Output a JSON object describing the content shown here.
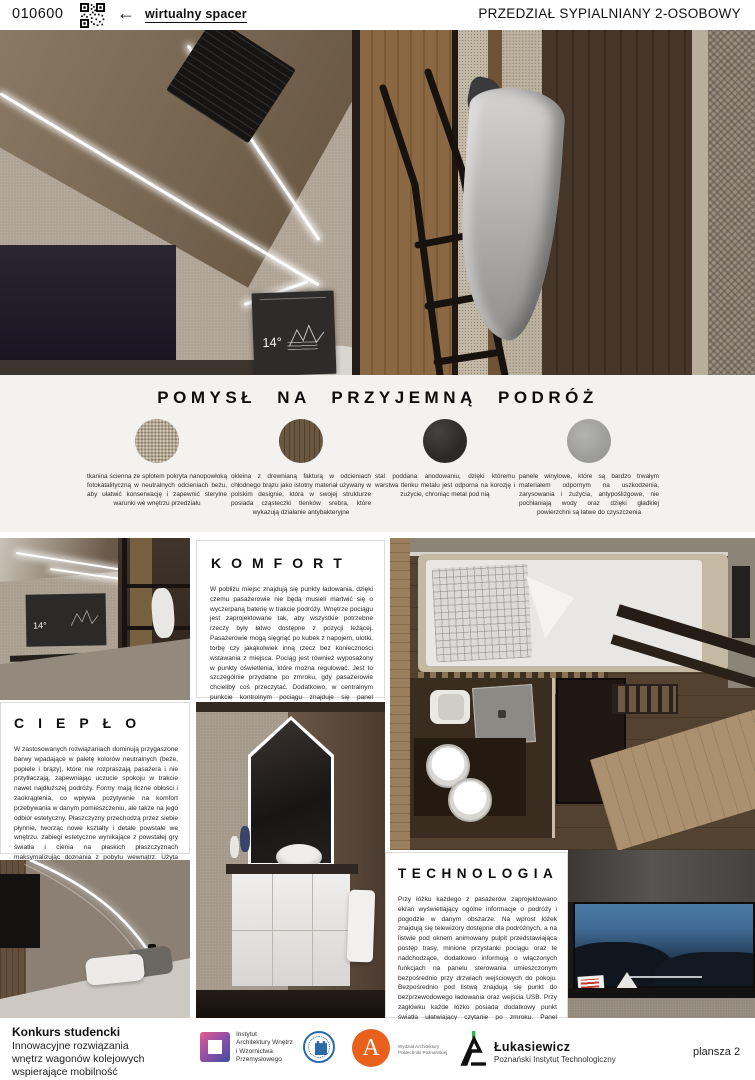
{
  "header": {
    "code": "010600",
    "virtual_tour_label": "wirtualny spacer",
    "title": "PRZEDZIAŁ SYPIALNIANY 2-OSOBOWY"
  },
  "icons": {
    "arrow_left": "←"
  },
  "screens": {
    "temperature": "14°"
  },
  "materials": {
    "title": "POMYSŁ NA PRZYJEMNĄ PODRÓŻ",
    "swatches": [
      {
        "name": "tkanina ścienna",
        "color": "#b3a690",
        "description": "tkanina ścienna ze splotem pokryta nanopowłoką fotokatalityczną w neutralnych odcieniach beżu, aby ułatwić konserwację i zapewnić sterylne warunki we wnętrzu przedziału"
      },
      {
        "name": "okleina drewniana",
        "color": "#6b5740",
        "description": "okleina z drewnianą fakturą w odcieniach chłodnego brązu jako istotny materiał używany w polskim designie, która w swojej strukturze posiada cząsteczki tlenków srebra, które wykazują działanie antybakteryjne"
      },
      {
        "name": "stal anodowana",
        "color": "#2c2a27",
        "description": "stal poddana anodowaniu, dzięki któremu warstwa tlenku metalu jest odporna na korozję i zużycie, chroniąc metal pod nią"
      },
      {
        "name": "panele winylowe",
        "color": "#9b9b99",
        "description": "panele winylowe, które są bardzo trwałym materiałem odpornym na uszkodzenia, zarysowania i zużycia, antypoślizgowe, nie pochłaniają wody oraz dzięki gładkiej powierzchni są łatwe do czyszczenia"
      }
    ]
  },
  "sections": {
    "komfort": {
      "title": "KOMFORT",
      "body": "W pobliżu miejsc znajdują się punkty ładowania, dzięki czemu pasażerowie nie będą musieli martwić się o wyczerpaną baterię w trakcie podróży. Wnętrze pociągu jest zaprojektowane tak, aby wszystkie potrzebne rzeczy były łatwo dostępne z pozycji leżącej. Pasażerowie mogą sięgnąć po kubek z napojem, ulotki, torbę czy jakąkolwiek inną rzecz bez konieczności wstawania z miejsca. Pociąg jest również wyposażony w punkty oświetlenia, które można regulować. Jest to szczególnie przydatne po zmroku, gdy pasażerowie chcieliby coś przeczytać. Dodatkowo, w centralnym punkcie kontrolnym pociągu znajduje się panel sterowania, który umożliwia pasażerom regulowanie temperatury i jasności świateł. Dzięki temu podróżni mogą dostosować warunki w pokoju do swoich preferencji, zapewniając sobie maksymalny komfort podczas podróży."
    },
    "cieplo": {
      "title": "CIEPŁO",
      "body": "W zastosowanych rozwiązaniach dominują przygaszone barwy wpadające w paletę kolorów neutralnych (beże, popiele i brązy), które nie rozpraszają pasażera i nie przytłaczają, zapewniając uczucie spokoju w trakcie nawet najdłuższej podróży. Formy mają liczne obłości i zaokrąglenia, co wpływa pozytywnie na komfort przebywania w danym pomieszczeniu, ale także na jego odbiór estetyczny. Płaszczyzny przechodzą przez siebie płynnie, tworząc nowe kształty i detale powstałe we wnętrzu. zabiegi estetyczne wynikające z powstałej gry światła i cienia na płaskich płaszczyznach maksymalizując doznania z pobytu wewnątrz. Użyta tkanina w połączeniu z drewnem ociepla pomieszczenie."
    },
    "technologia": {
      "title": "TECHNOLOGIA",
      "body": "Przy łóżku każdego z pasażerów zaprojektowano ekran wyświetlający ogólne informacje o podróży i pogodzie w danym obszarze. Na wprost łóżek znajdują się telewizory dostępne dla podróżnych, a na listwie pod oknem animowany pulpit przedstawiająca postęp trasy, minione przystanki pociągu oraz te nadchodzące, dodatkowo informują o włączonych funkcjach na panelu sterowania umieszczonym bezpośrednio przy drzwiach wejściowych do pokoju. Bezpośrednio pod listwą znajdują się punkt do bezprzewodowego ładowania oraz wejścia USB. Przy zagłówku każde łóżko posiada dodatkowy punkt światła ułatwiający czytanie po zmroku. Panel sterujący umożliwia sterowanie temperaturą, natężeniem i kolorystyką światła oraz poziomem nawilżenia powietrza i klimatyzacją."
    }
  },
  "footer": {
    "competition_heading": "Konkurs studencki",
    "competition_description": "Innowacyjne rozwiązania\nwnętrz wagonów kolejowych\nwspierające mobilność\nosób niepełnosprawnych",
    "logos": {
      "institute_label": "Instytut\nArchitektury Wnętrz\ni Wzornictwa\nPrzemysłowego",
      "architecture_initial": "A",
      "architecture_label": "Wydział Architektury\nPolitechniki Poznańskiej",
      "lukasiewicz_name": "Łukasiewicz",
      "lukasiewicz_subtitle": "Poznański Instytut Technologiczny"
    },
    "page_label": "plansza 2"
  }
}
